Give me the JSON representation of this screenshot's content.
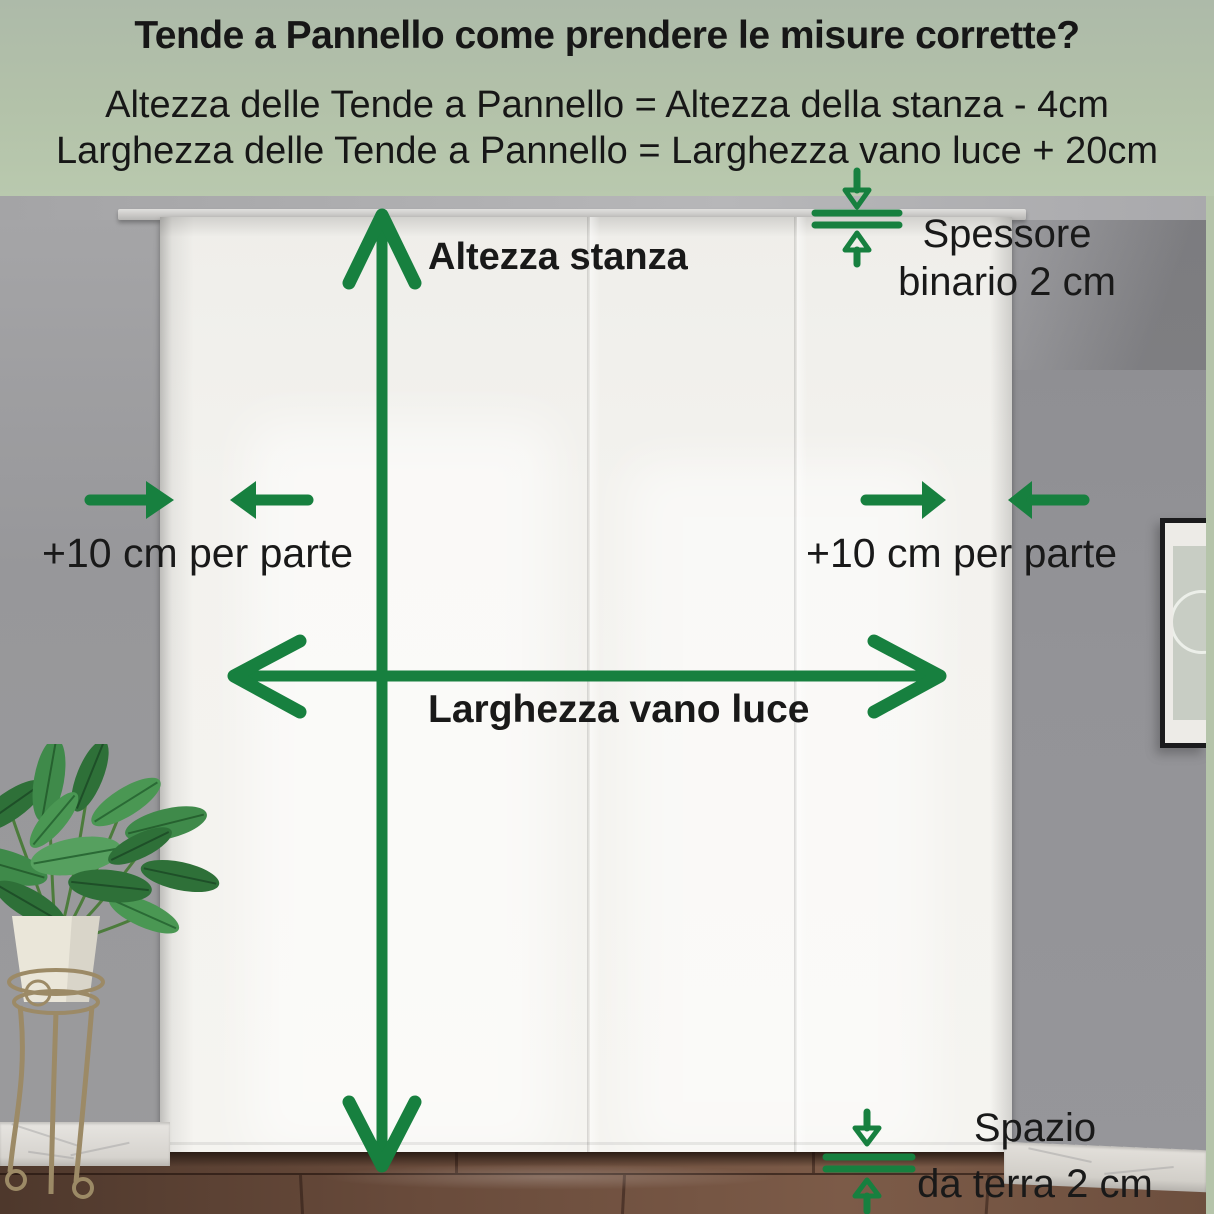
{
  "header": {
    "title": "Tende a Pannello come prendere le misure corrette?",
    "formula_height": "Altezza delle Tende a Pannello = Altezza della stanza - 4cm",
    "formula_width": "Larghezza delle Tende a Pannello = Larghezza vano luce + 20cm"
  },
  "annotations": {
    "room_height_label": "Altezza stanza",
    "rail_thickness_line1": "Spessore",
    "rail_thickness_line2": "binario 2 cm",
    "left_margin_label": "+10 cm per parte",
    "right_margin_label": "+10 cm per parte",
    "opening_width_label": "Larghezza vano luce",
    "floor_gap_line1": "Spazio",
    "floor_gap_line2": "da terra 2 cm"
  },
  "colors": {
    "annotation_green": "#17803f",
    "header_background": "#b2c1a8",
    "label_text": "#191919"
  }
}
